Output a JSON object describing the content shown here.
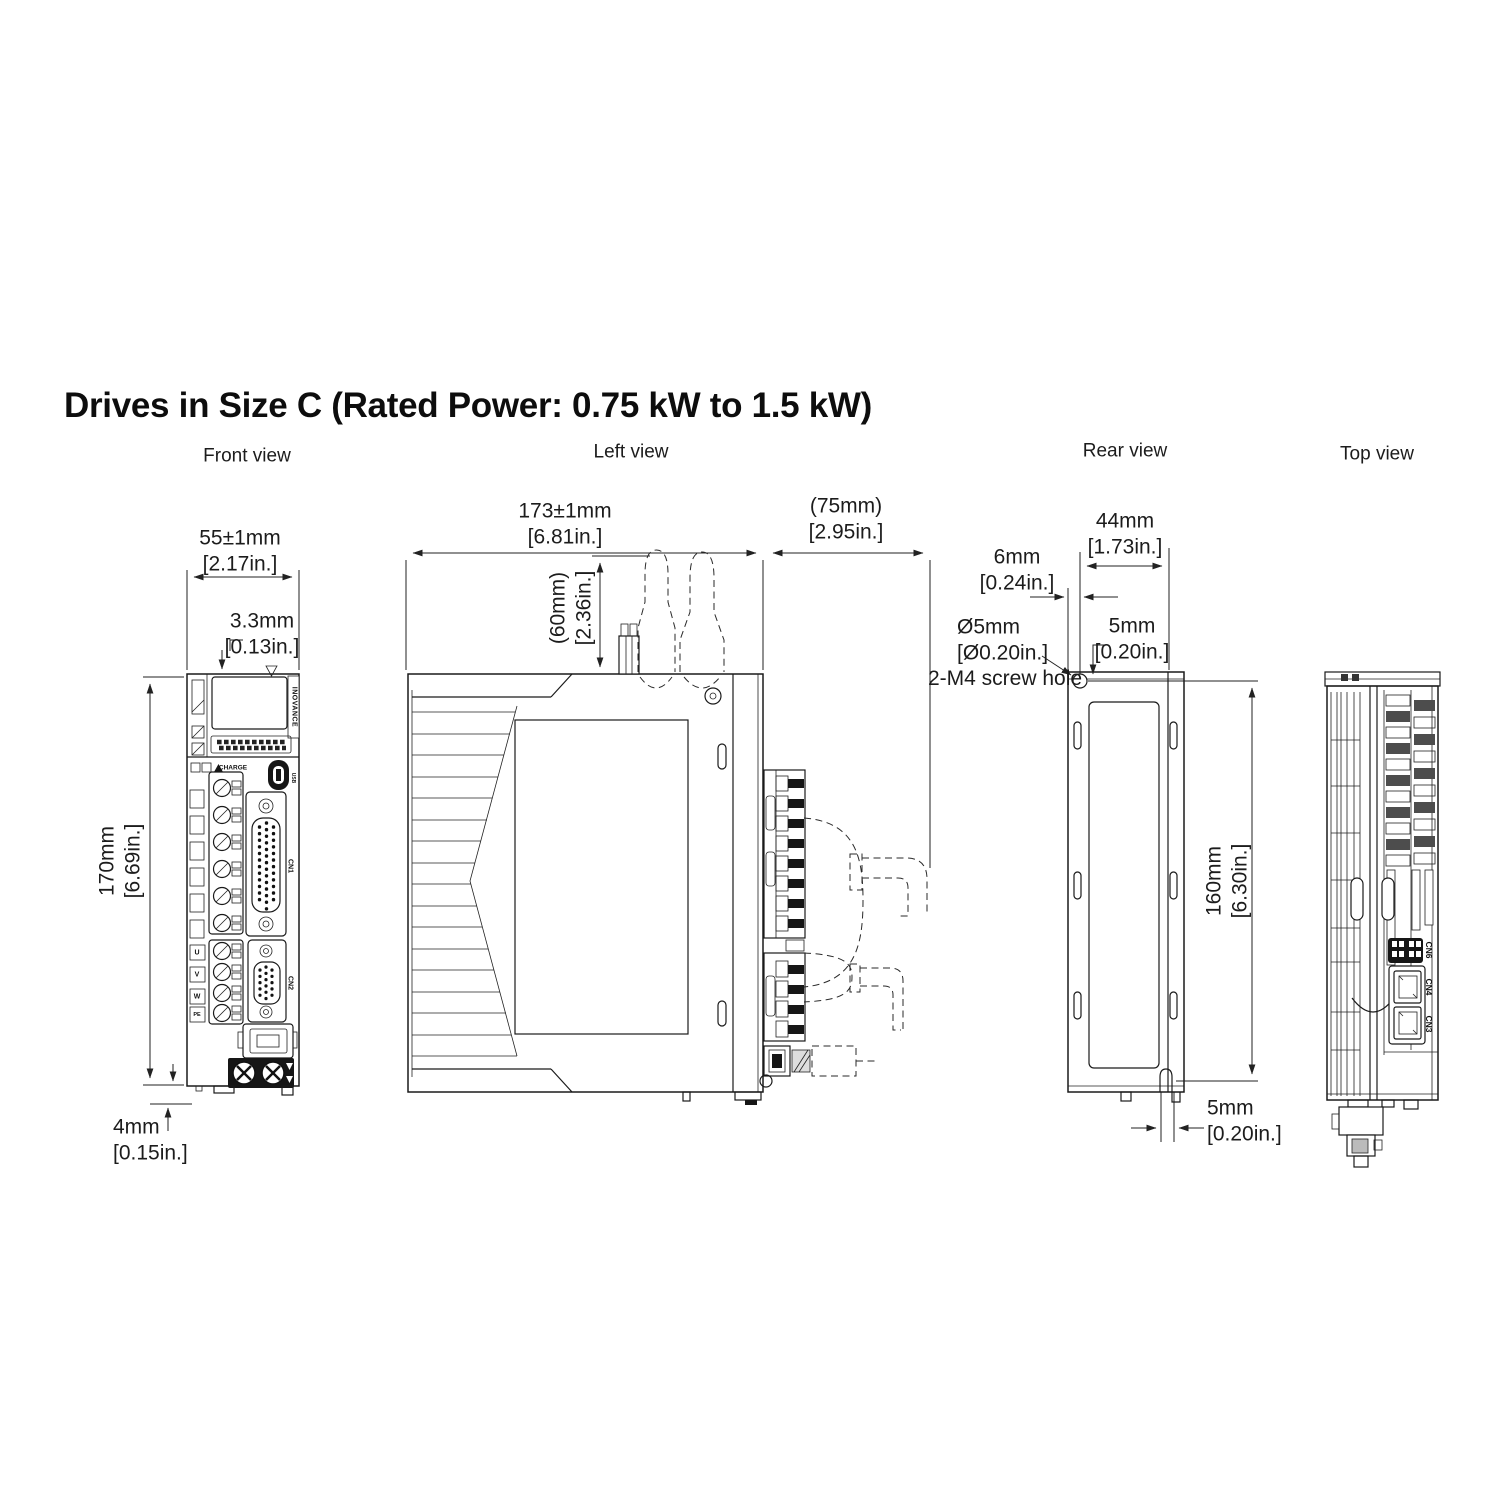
{
  "title": "Drives in Size C (Rated Power: 0.75 kW to 1.5 kW)",
  "views": {
    "front": {
      "label": "Front view",
      "dim_width": "55±1mm",
      "dim_width_in": "[2.17in.]",
      "dim_step": "3.3mm",
      "dim_step_in": "[0.13in.]",
      "dim_height": "170mm",
      "dim_height_in": "[6.69in.]",
      "dim_foot": "4mm",
      "dim_foot_in": "[0.15in.]",
      "brand": "INOVANCE",
      "charge_label": "CHARGE",
      "usb_label": "USB",
      "cn1_label": "CN1",
      "cn2_label": "CN2",
      "terminals": [
        "U",
        "V",
        "W",
        "PE"
      ]
    },
    "left": {
      "label": "Left view",
      "dim_depth": "173±1mm",
      "dim_depth_in": "[6.81in.]",
      "dim_front_clearance": "(75mm)",
      "dim_front_clearance_in": "[2.95in.]",
      "dim_top_clearance": "(60mm)",
      "dim_top_clearance_in": "[2.36in.]"
    },
    "rear": {
      "label": "Rear view",
      "dim_edge": "6mm",
      "dim_edge_in": "[0.24in.]",
      "dim_width": "44mm",
      "dim_width_in": "[1.73in.]",
      "dim_hole": "Ø5mm",
      "dim_hole_in": "[Ø0.20in.]",
      "screw_note": "2-M4 screw hole",
      "dim_top_offset": "5mm",
      "dim_top_offset_in": "[0.20in.]",
      "dim_height": "160mm",
      "dim_height_in": "[6.30in.]",
      "dim_bottom_offset": "5mm",
      "dim_bottom_offset_in": "[0.20in.]"
    },
    "top": {
      "label": "Top view",
      "connectors": [
        "CN6",
        "CN4",
        "CN3"
      ]
    }
  }
}
